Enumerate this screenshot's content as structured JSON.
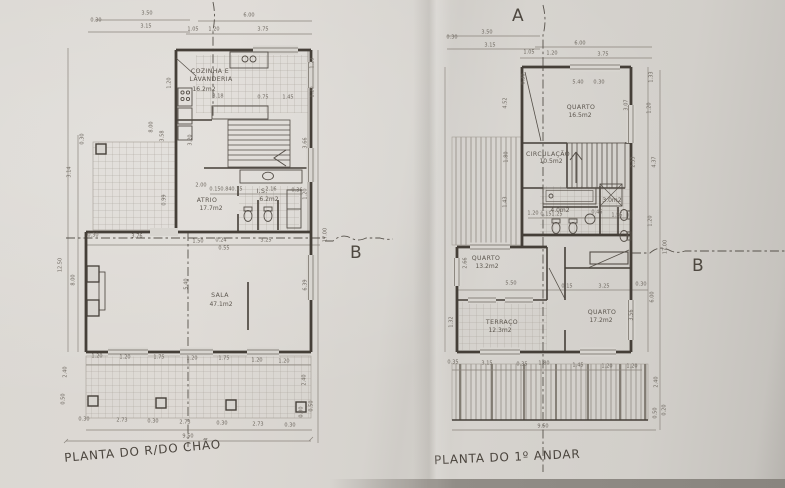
{
  "titles": {
    "ground_floor": "PLANTA DO R/DO CHÃO",
    "first_floor": "PLANTA DO 1º ANDAR"
  },
  "section_markers": {
    "a": "A",
    "b": "B"
  },
  "plans": [
    {
      "id": "ground-floor",
      "title": "PLANTA DO R/DO CHÃO",
      "rooms": [
        {
          "name": "COZINHA E LAVANDERIA",
          "area": "16.2m2"
        },
        {
          "name": "ATRIO",
          "area": "17.7m2"
        },
        {
          "name": "I.S.",
          "area": "6.2m2"
        },
        {
          "name": "SALA",
          "area": "47.1m2"
        }
      ],
      "labels": [
        {
          "t": "3.50",
          "x": 147,
          "y": 14
        },
        {
          "t": "0.30",
          "x": 96,
          "y": 21
        },
        {
          "t": "3.15",
          "x": 146,
          "y": 27
        },
        {
          "t": "6.00",
          "x": 249,
          "y": 16
        },
        {
          "t": "1.05",
          "x": 193,
          "y": 30
        },
        {
          "t": "1.20",
          "x": 214,
          "y": 30
        },
        {
          "t": "3.75",
          "x": 263,
          "y": 30
        },
        {
          "t": "1.23",
          "x": 313,
          "y": 63,
          "r": -90
        },
        {
          "t": "1.20",
          "x": 313,
          "y": 92,
          "r": -90
        },
        {
          "t": "3.66",
          "x": 306,
          "y": 143,
          "r": -90
        },
        {
          "t": "1.20",
          "x": 306,
          "y": 194,
          "r": -90
        },
        {
          "t": "17.00",
          "x": 326,
          "y": 235,
          "r": -90
        },
        {
          "t": "6.39",
          "x": 306,
          "y": 285,
          "r": -90
        },
        {
          "t": "2.40",
          "x": 305,
          "y": 380,
          "r": -90
        },
        {
          "t": "0.30",
          "x": 302,
          "y": 412,
          "r": -90
        },
        {
          "t": "0.50",
          "x": 312,
          "y": 406,
          "r": -90
        },
        {
          "t": "0.30",
          "x": 83,
          "y": 139,
          "r": -90
        },
        {
          "t": "3.14",
          "x": 70,
          "y": 172,
          "r": -90
        },
        {
          "t": "12.50",
          "x": 61,
          "y": 265,
          "r": -90
        },
        {
          "t": "8.00",
          "x": 74,
          "y": 280,
          "r": -90
        },
        {
          "t": "8.00",
          "x": 152,
          "y": 127,
          "r": -90
        },
        {
          "t": "3.58",
          "x": 163,
          "y": 136,
          "r": -90
        },
        {
          "t": "0.99",
          "x": 165,
          "y": 200,
          "r": -90
        },
        {
          "t": "0.50",
          "x": 64,
          "y": 399,
          "r": -90
        },
        {
          "t": "2.40",
          "x": 66,
          "y": 372,
          "r": -90
        },
        {
          "t": "1.20",
          "x": 170,
          "y": 83,
          "r": -90
        },
        {
          "t": "3.20",
          "x": 191,
          "y": 140,
          "r": -90
        },
        {
          "t": "COZINHA E",
          "x": 210,
          "y": 72,
          "k": "room"
        },
        {
          "t": "LAVANDERIA",
          "x": 211,
          "y": 80,
          "k": "room"
        },
        {
          "t": "16.2m2",
          "x": 204,
          "y": 90,
          "k": "area"
        },
        {
          "t": "3.18",
          "x": 218,
          "y": 97
        },
        {
          "t": "0.75",
          "x": 263,
          "y": 98
        },
        {
          "t": "1.45",
          "x": 288,
          "y": 98
        },
        {
          "t": "2.00",
          "x": 201,
          "y": 186
        },
        {
          "t": "0.15",
          "x": 215,
          "y": 190
        },
        {
          "t": "0.84",
          "x": 226,
          "y": 190
        },
        {
          "t": "0.15",
          "x": 237,
          "y": 190
        },
        {
          "t": "2.16",
          "x": 271,
          "y": 190
        },
        {
          "t": "0.36",
          "x": 297,
          "y": 191
        },
        {
          "t": "ATRIO",
          "x": 207,
          "y": 201,
          "k": "room"
        },
        {
          "t": "17.7m2",
          "x": 211,
          "y": 209,
          "k": "area"
        },
        {
          "t": "I.S.",
          "x": 262,
          "y": 192,
          "k": "room"
        },
        {
          "t": "6.2m2",
          "x": 269,
          "y": 200,
          "k": "area"
        },
        {
          "t": "0.30",
          "x": 93,
          "y": 236
        },
        {
          "t": "3.76",
          "x": 137,
          "y": 237
        },
        {
          "t": "1.50",
          "x": 198,
          "y": 242
        },
        {
          "t": "0.24",
          "x": 221,
          "y": 241
        },
        {
          "t": "0.55",
          "x": 224,
          "y": 249
        },
        {
          "t": "3.25",
          "x": 266,
          "y": 241
        },
        {
          "t": "SALA",
          "x": 220,
          "y": 296,
          "k": "room"
        },
        {
          "t": "47.1m2",
          "x": 221,
          "y": 305,
          "k": "area"
        },
        {
          "t": "5.40",
          "x": 187,
          "y": 284,
          "r": -90
        },
        {
          "t": "1.20",
          "x": 97,
          "y": 357
        },
        {
          "t": "1.20",
          "x": 125,
          "y": 358
        },
        {
          "t": "1.75",
          "x": 159,
          "y": 358
        },
        {
          "t": "1.20",
          "x": 192,
          "y": 359
        },
        {
          "t": "1.75",
          "x": 224,
          "y": 359
        },
        {
          "t": "1.20",
          "x": 257,
          "y": 361
        },
        {
          "t": "1.20",
          "x": 284,
          "y": 362
        },
        {
          "t": "0.30",
          "x": 84,
          "y": 420
        },
        {
          "t": "2.73",
          "x": 122,
          "y": 421
        },
        {
          "t": "0.30",
          "x": 153,
          "y": 422
        },
        {
          "t": "2.73",
          "x": 185,
          "y": 423
        },
        {
          "t": "0.30",
          "x": 222,
          "y": 424
        },
        {
          "t": "2.73",
          "x": 258,
          "y": 425
        },
        {
          "t": "0.30",
          "x": 290,
          "y": 426
        },
        {
          "t": "9.50",
          "x": 188,
          "y": 437
        }
      ]
    },
    {
      "id": "first-floor",
      "title": "PLANTA DO 1º ANDAR",
      "rooms": [
        {
          "name": "QUARTO",
          "area": "16.5m2"
        },
        {
          "name": "CIRCULAÇÃO",
          "area": "10.5m2"
        },
        {
          "area": "4.0m2"
        },
        {
          "area": "3.0m2"
        },
        {
          "name": "QUARTO",
          "area": "13.2m2"
        },
        {
          "name": "TERRAÇO",
          "area": "12.3m2"
        },
        {
          "name": "QUARTO",
          "area": "17.2m2"
        }
      ],
      "labels": [
        {
          "t": "3.50",
          "x": 487,
          "y": 33
        },
        {
          "t": "0.30",
          "x": 452,
          "y": 38
        },
        {
          "t": "3.15",
          "x": 490,
          "y": 46
        },
        {
          "t": "6.00",
          "x": 580,
          "y": 44
        },
        {
          "t": "1.05",
          "x": 529,
          "y": 53
        },
        {
          "t": "1.20",
          "x": 552,
          "y": 54
        },
        {
          "t": "3.75",
          "x": 603,
          "y": 55
        },
        {
          "t": "5.40",
          "x": 578,
          "y": 83
        },
        {
          "t": "0.30",
          "x": 524,
          "y": 79,
          "r": -90
        },
        {
          "t": "0.30",
          "x": 599,
          "y": 83
        },
        {
          "t": "1.33",
          "x": 652,
          "y": 77,
          "r": -90
        },
        {
          "t": "1.20",
          "x": 650,
          "y": 108,
          "r": -90
        },
        {
          "t": "3.07",
          "x": 627,
          "y": 105,
          "r": -90
        },
        {
          "t": "4.52",
          "x": 506,
          "y": 103,
          "r": -90
        },
        {
          "t": "QUARTO",
          "x": 581,
          "y": 108,
          "k": "room"
        },
        {
          "t": "16.5m2",
          "x": 580,
          "y": 116,
          "k": "area"
        },
        {
          "t": "CIRCULAÇÃO",
          "x": 548,
          "y": 155,
          "k": "room"
        },
        {
          "t": "10.5m2",
          "x": 551,
          "y": 162,
          "k": "area"
        },
        {
          "t": "2.33",
          "x": 634,
          "y": 162,
          "r": -90
        },
        {
          "t": "4.37",
          "x": 655,
          "y": 162,
          "r": -90
        },
        {
          "t": "1.80",
          "x": 507,
          "y": 157,
          "r": -90
        },
        {
          "t": "1.43",
          "x": 506,
          "y": 202,
          "r": -90
        },
        {
          "t": "4.0m2",
          "x": 560,
          "y": 211,
          "k": "area"
        },
        {
          "t": "3.0m2",
          "x": 612,
          "y": 201,
          "k": "area"
        },
        {
          "t": "1.20",
          "x": 533,
          "y": 214
        },
        {
          "t": "0.15",
          "x": 546,
          "y": 215
        },
        {
          "t": "1.25",
          "x": 557,
          "y": 215
        },
        {
          "t": "0.45",
          "x": 597,
          "y": 213
        },
        {
          "t": "1.55",
          "x": 617,
          "y": 216
        },
        {
          "t": "1.20",
          "x": 651,
          "y": 221,
          "r": -90
        },
        {
          "t": "17.00",
          "x": 666,
          "y": 247,
          "r": -90
        },
        {
          "t": "QUARTO",
          "x": 486,
          "y": 259,
          "k": "room"
        },
        {
          "t": "13.2m2",
          "x": 487,
          "y": 267,
          "k": "area"
        },
        {
          "t": "2.66",
          "x": 466,
          "y": 263,
          "r": -90
        },
        {
          "t": "5.50",
          "x": 511,
          "y": 284
        },
        {
          "t": "0.15",
          "x": 567,
          "y": 287
        },
        {
          "t": "3.25",
          "x": 604,
          "y": 287
        },
        {
          "t": "0.30",
          "x": 641,
          "y": 285
        },
        {
          "t": "6.00",
          "x": 653,
          "y": 297,
          "r": -90
        },
        {
          "t": "3.56",
          "x": 632,
          "y": 315,
          "r": -90
        },
        {
          "t": "TERRAÇO",
          "x": 502,
          "y": 323,
          "k": "room"
        },
        {
          "t": "12.3m2",
          "x": 500,
          "y": 331,
          "k": "area"
        },
        {
          "t": "QUARTO",
          "x": 602,
          "y": 313,
          "k": "room"
        },
        {
          "t": "17.2m2",
          "x": 601,
          "y": 321,
          "k": "area"
        },
        {
          "t": "1.32",
          "x": 452,
          "y": 322,
          "r": -90
        },
        {
          "t": "0.35",
          "x": 453,
          "y": 363
        },
        {
          "t": "3.15",
          "x": 487,
          "y": 364
        },
        {
          "t": "0.35",
          "x": 522,
          "y": 365
        },
        {
          "t": "1.80",
          "x": 544,
          "y": 364
        },
        {
          "t": "1.45",
          "x": 578,
          "y": 366
        },
        {
          "t": "1.20",
          "x": 607,
          "y": 367
        },
        {
          "t": "1.20",
          "x": 632,
          "y": 367
        },
        {
          "t": "2.40",
          "x": 657,
          "y": 382,
          "r": -90
        },
        {
          "t": "0.50",
          "x": 656,
          "y": 413,
          "r": -90
        },
        {
          "t": "0.20",
          "x": 665,
          "y": 410,
          "r": -90
        },
        {
          "t": "9.50",
          "x": 543,
          "y": 427
        }
      ]
    }
  ]
}
